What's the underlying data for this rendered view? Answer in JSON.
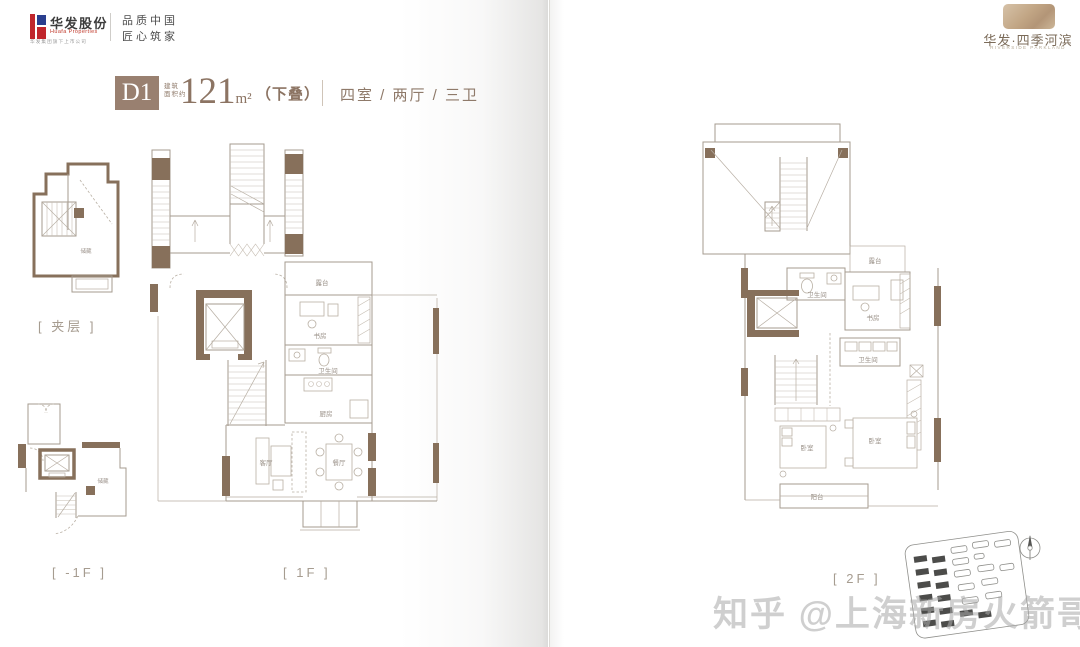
{
  "header": {
    "logo": {
      "name": "华发股份",
      "name_en": "Huafa Properties",
      "tagline": "华发集团旗下上市公司",
      "slogan_line1": "品质中国",
      "slogan_line2": "匠心筑家"
    },
    "project": {
      "name": "华发·四季河滨",
      "name_en": "RIVERSIDE PARKLAND"
    }
  },
  "unit": {
    "code": "D1",
    "area_label_line1": "建筑",
    "area_label_line2": "面积约",
    "area_value": "121",
    "area_unit": "m²",
    "area_note": "（下叠）",
    "rooms_summary": "四室 / 两厅 / 三卫"
  },
  "floors": {
    "mezzanine": {
      "label": "[ 夹层 ]",
      "room": "储藏"
    },
    "basement": {
      "label": "[ -1F ]",
      "room": "储藏"
    },
    "first": {
      "label": "[ 1F ]",
      "rooms": {
        "terrace": "露台",
        "study": "书房",
        "bath": "卫生间",
        "kitchen": "厨房",
        "living": "客厅",
        "dining": "餐厅"
      }
    },
    "second": {
      "label": "[ 2F ]",
      "rooms": {
        "bath1": "卫生间",
        "terrace": "露台",
        "study": "书房",
        "bath2": "卫生间",
        "bedroom_left": "卧室",
        "bedroom_right": "卧室",
        "balcony": "阳台"
      }
    }
  },
  "watermark": "知乎 @上海新房火箭哥",
  "colors": {
    "accent_brown": "#998070",
    "wall_brown": "#87705b",
    "line_gray": "#a59b8f",
    "label_gray": "#a69c90",
    "logo_red": "#c0272d",
    "logo_blue": "#2a3f8f"
  }
}
